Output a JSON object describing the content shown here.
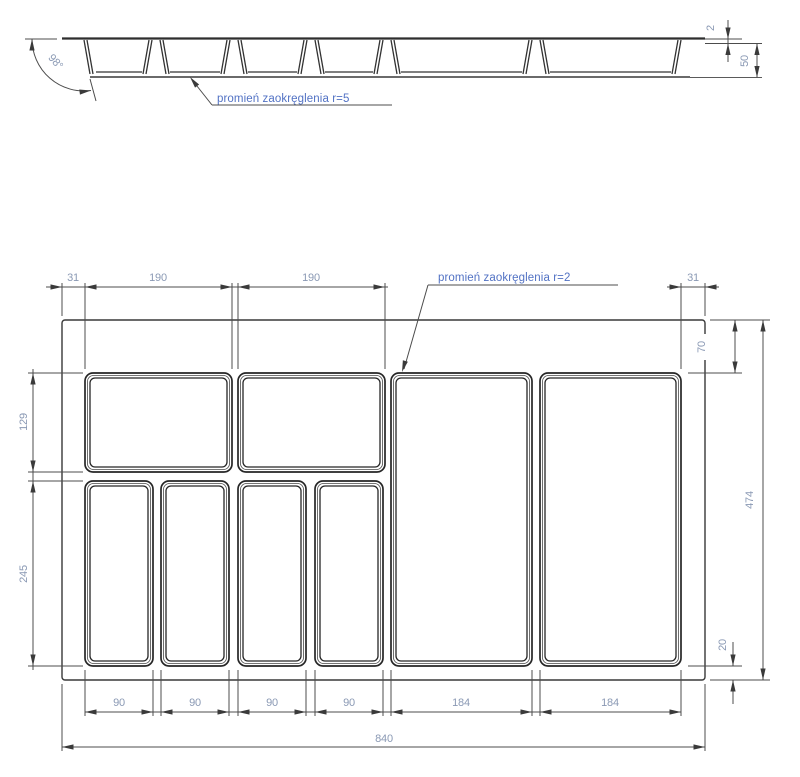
{
  "section": {
    "angle": "98°",
    "sheet_thickness": "2",
    "depth": "50",
    "fillet_note": "promień zaokręglenia r=5"
  },
  "plan": {
    "fillet_note": "promień zaokręglenia r=2",
    "margin_left": "31",
    "top_width_1": "190",
    "top_width_2": "190",
    "margin_right": "31",
    "row1_height": "129",
    "row2_height": "245",
    "top_inset": "70",
    "total_height": "474",
    "bottom_inset": "20",
    "bottom_dims": [
      "90",
      "90",
      "90",
      "90",
      "184",
      "184"
    ],
    "total_width": "840"
  },
  "colors": {
    "dimension_text": "#8a99b4",
    "note_text": "#5272c4",
    "line": "#383838"
  }
}
